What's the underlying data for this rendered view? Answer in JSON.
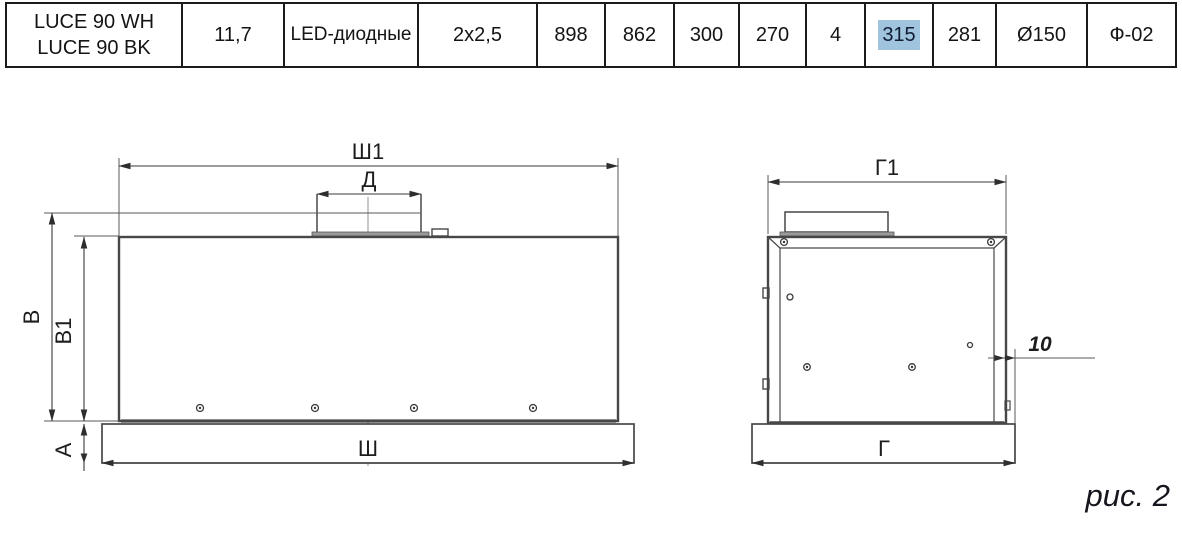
{
  "table": {
    "cells": [
      "LUCE 90 WH\nLUCE 90 BK",
      "11,7",
      "LED-диодные",
      "2x2,5",
      "898",
      "862",
      "300",
      "270",
      "4",
      "315",
      "281",
      "Ø150",
      "Ф-02"
    ],
    "highlight": {
      "cell_index": 9,
      "value": "315",
      "color": "#a0c4dd"
    }
  },
  "front_view": {
    "labels": {
      "sh1": "Ш1",
      "d": "Д",
      "v": "В",
      "v1": "В1",
      "a": "А",
      "sh": "Ш"
    }
  },
  "side_view": {
    "labels": {
      "g1": "Г1",
      "g": "Г",
      "offset": "10"
    }
  },
  "caption": "рис. 2",
  "colors": {
    "line": "#474747",
    "highlight": "#a0c4dd"
  }
}
